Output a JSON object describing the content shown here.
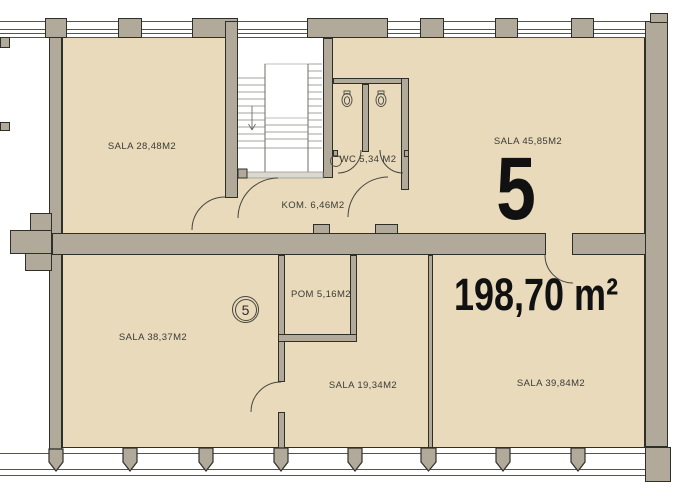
{
  "plan": {
    "unit_number": "5",
    "unit_area": "198,70 m²",
    "unit_marker": "5",
    "rooms": {
      "sala_2848": "SALA 28,48M2",
      "sala_4585": "SALA 45,85M2",
      "wc": "WC 5,34 M2",
      "kom": "KOM. 6,46M2",
      "pom": "POM 5,16M2",
      "sala_3837": "SALA 38,37M2",
      "sala_1934": "SALA 19,34M2",
      "sala_3984": "SALA 39,84M2"
    },
    "colors": {
      "floor": "#e8dabb",
      "wall": "#b1a99a",
      "outline": "#2f2f2a",
      "window_line": "#55554e",
      "stair_line": "#85857d",
      "text": "#3b3b35",
      "big_text": "#111111"
    }
  }
}
